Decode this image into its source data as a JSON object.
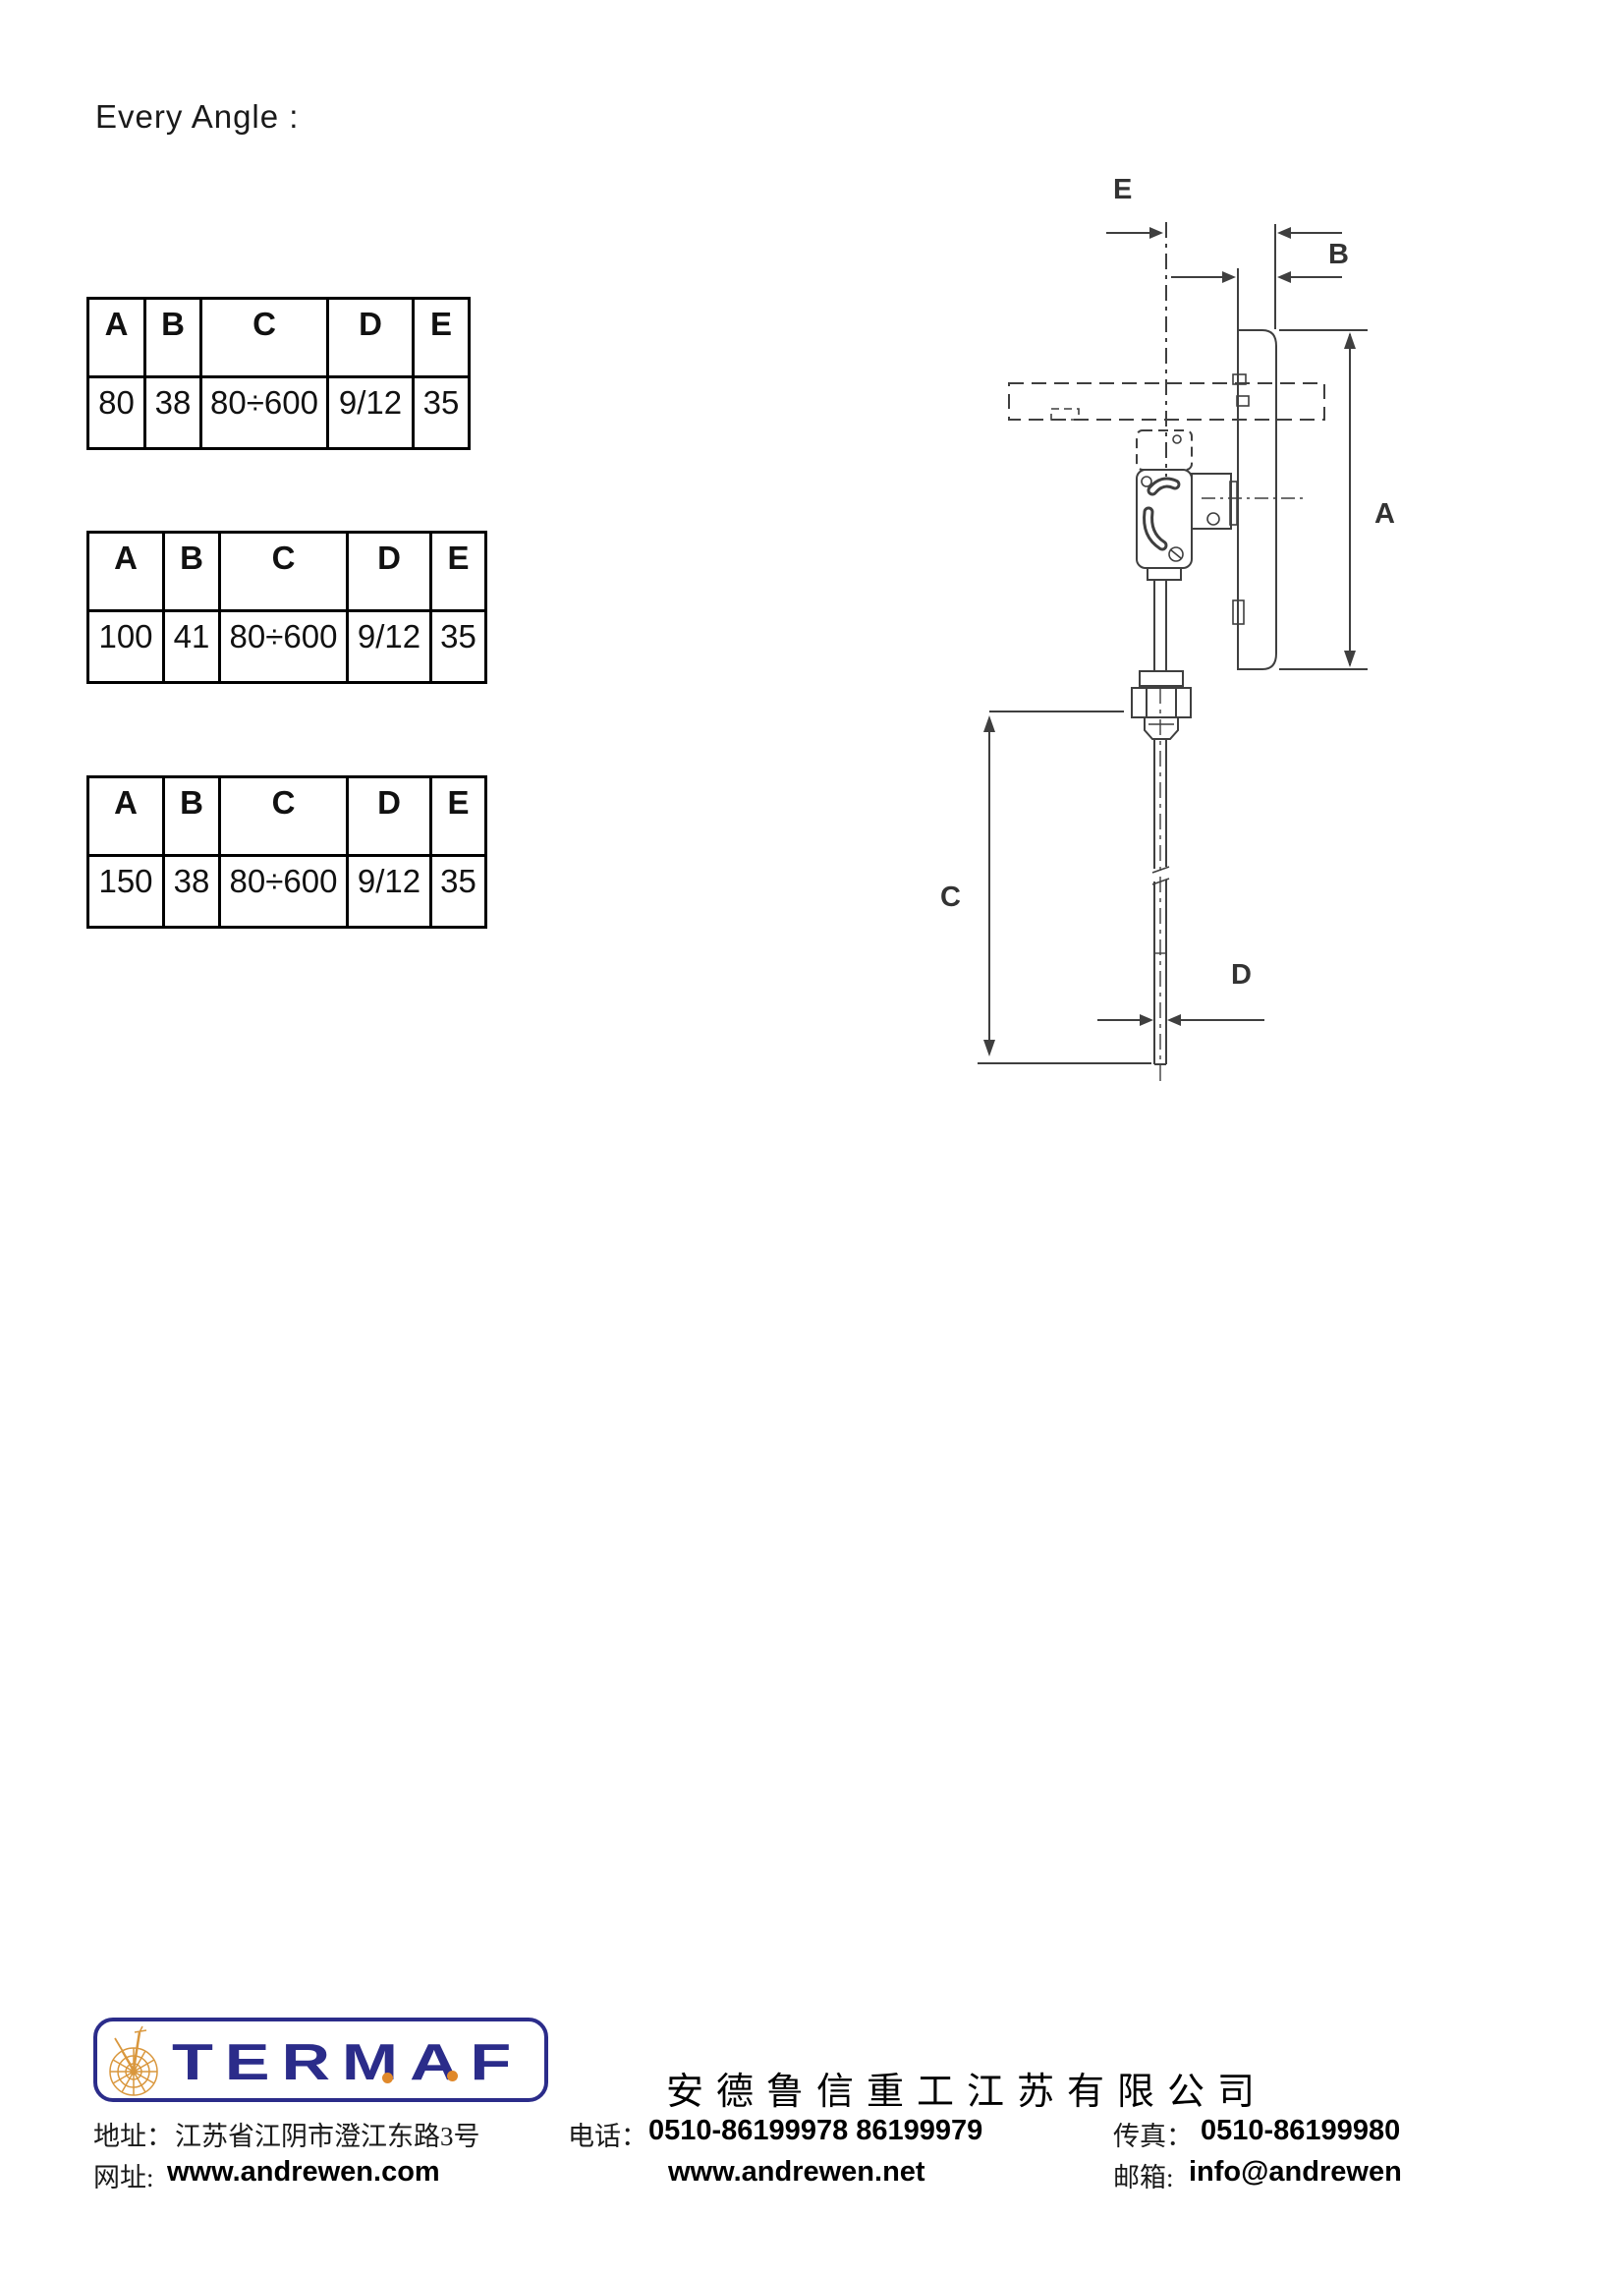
{
  "page": {
    "title": "Every Angle :"
  },
  "tables": [
    {
      "headers": [
        "A",
        "B",
        "C",
        "D",
        "E"
      ],
      "row": [
        "80",
        "38",
        "80÷600",
        "9/12",
        "35"
      ]
    },
    {
      "headers": [
        "A",
        "B",
        "C",
        "D",
        "E"
      ],
      "row": [
        "100",
        "41",
        "80÷600",
        "9/12",
        "35"
      ]
    },
    {
      "headers": [
        "A",
        "B",
        "C",
        "D",
        "E"
      ],
      "row": [
        "150",
        "38",
        "80÷600",
        "9/12",
        "35"
      ]
    }
  ],
  "diagram": {
    "labels": {
      "a": "A",
      "b": "B",
      "c": "C",
      "d": "D",
      "e": "E"
    }
  },
  "footer": {
    "logo_text": "TERMAF",
    "company_name": "安德鲁信重工江苏有限公司",
    "address_label": "地址：",
    "address": "江苏省江阴市澄江东路3号",
    "phone_label": "电话：",
    "phone": "0510-86199978  86199979",
    "fax_label": "传真：",
    "fax": "0510-86199980",
    "web_label": "网址:",
    "web1": "www.andrewen.com",
    "web2": "www.andrewen.net",
    "email_label": "邮箱:",
    "email": "info@andrewen",
    "brand_navy": "#2b2c8a",
    "brand_orange": "#e0892b"
  }
}
